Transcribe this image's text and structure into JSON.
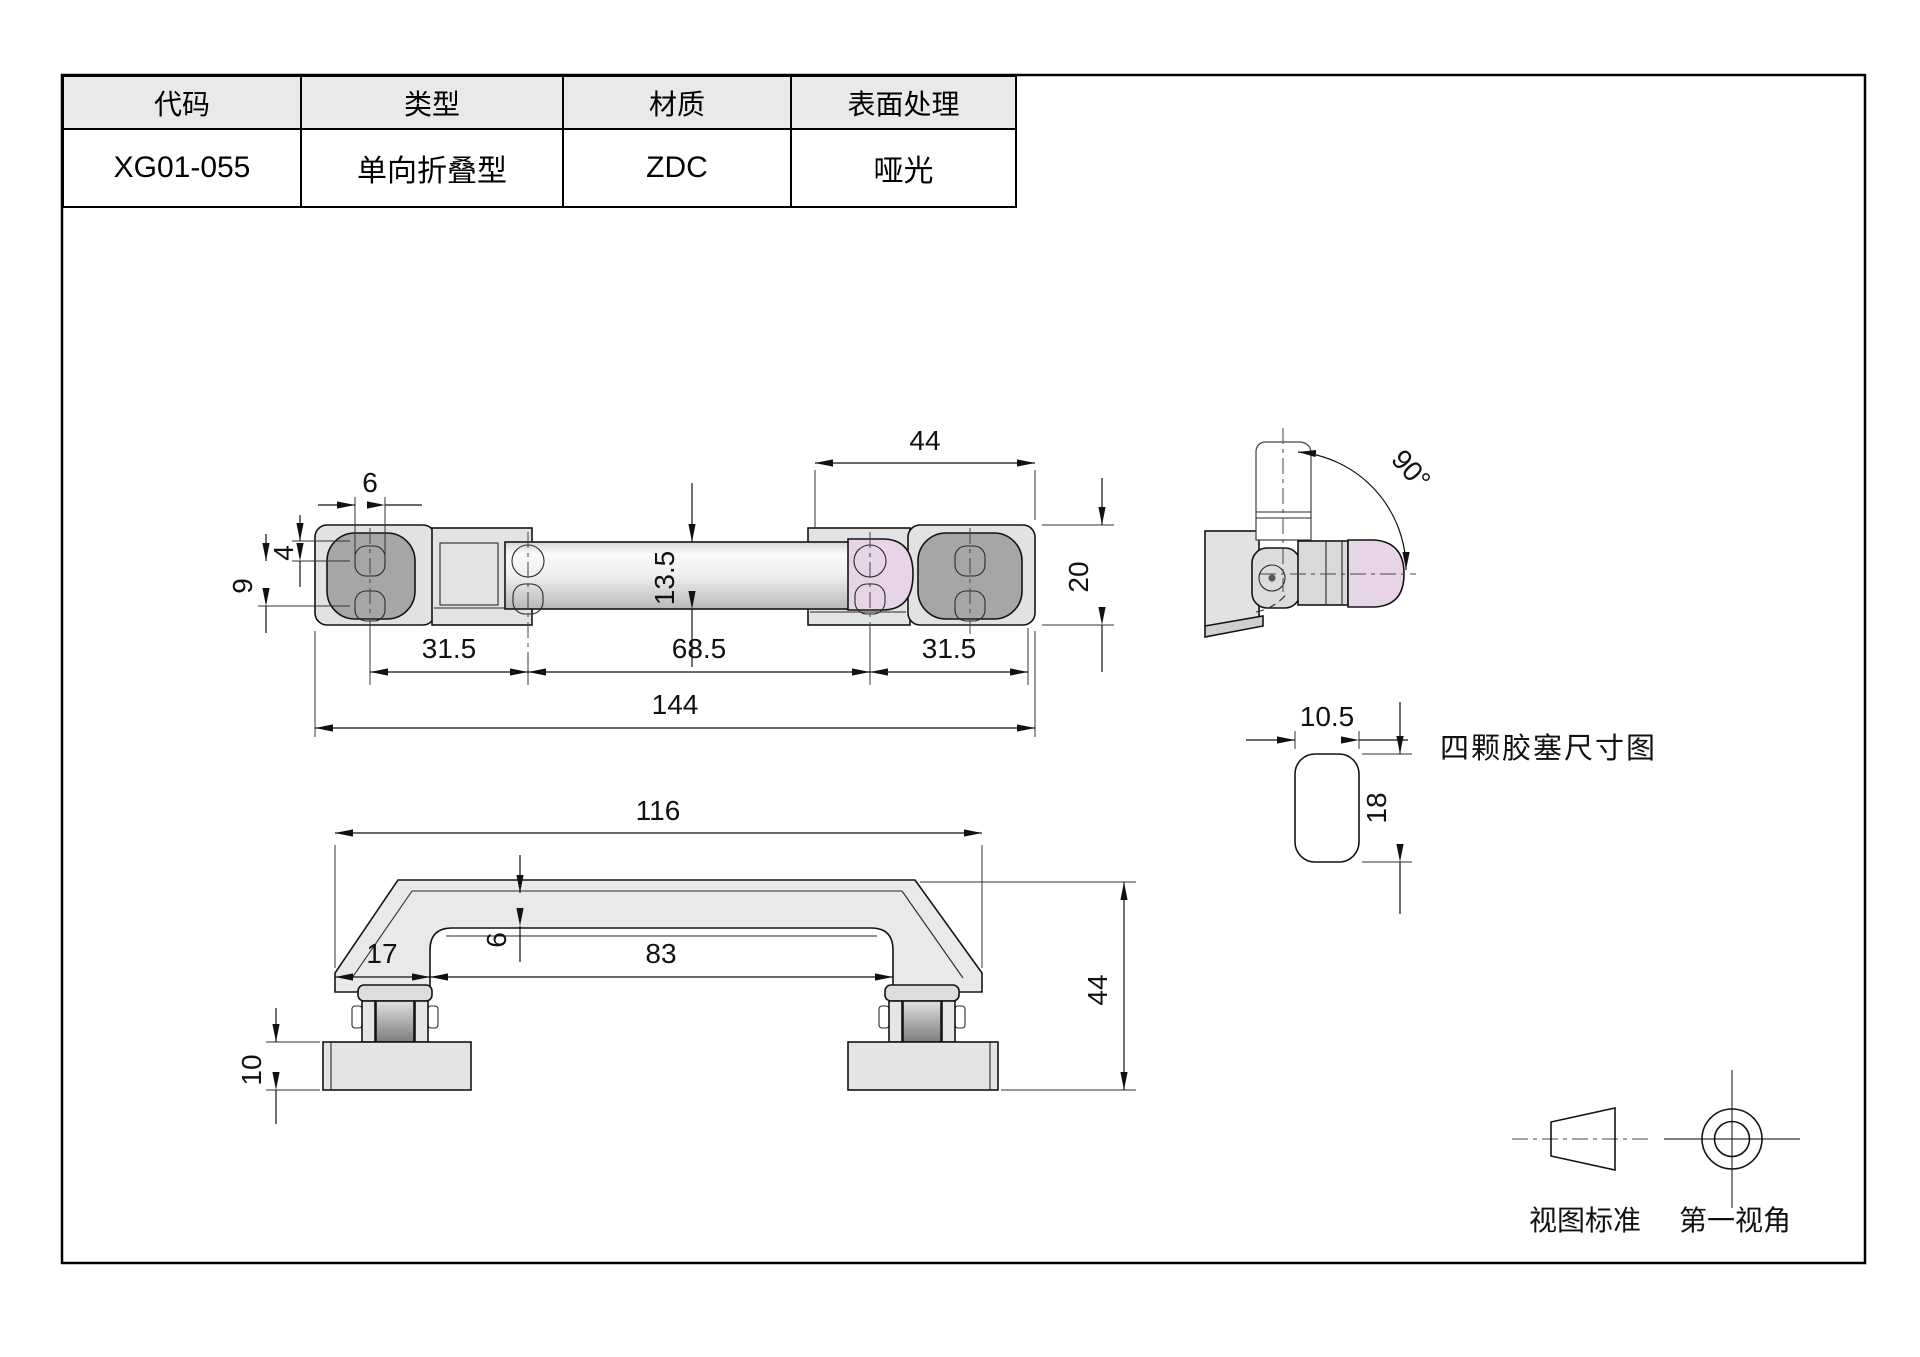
{
  "table": {
    "headers": [
      "代码",
      "类型",
      "材质",
      "表面处理"
    ],
    "rows": [
      [
        "XG01-055",
        "单向折叠型",
        "ZDC",
        "哑光"
      ]
    ]
  },
  "views": {
    "top_view": {
      "dim_6": "6",
      "dim_4": "4",
      "dim_9": "9",
      "dim_13_5": "13.5",
      "dim_44": "44",
      "dim_20": "20",
      "dim_31_5_left": "31.5",
      "dim_68_5": "68.5",
      "dim_31_5_right": "31.5",
      "dim_144": "144"
    },
    "side_view": {
      "dim_angle": "90°"
    },
    "plug_view": {
      "dim_width": "10.5",
      "dim_height": "18",
      "label": "四颗胶塞尺寸图"
    },
    "front_view": {
      "dim_116": "116",
      "dim_6": "6",
      "dim_17": "17",
      "dim_83": "83",
      "dim_44": "44",
      "dim_10": "10"
    }
  },
  "legend": {
    "view_standard_label": "视图标准",
    "first_angle_label": "第一视角"
  },
  "colors": {
    "accent_pink": "#e7d5e7",
    "part_grey": "#e2e2e2",
    "plug_dark_grey": "#a6a6a6",
    "header_bg": "#e9e9e9",
    "line": "#141414"
  }
}
